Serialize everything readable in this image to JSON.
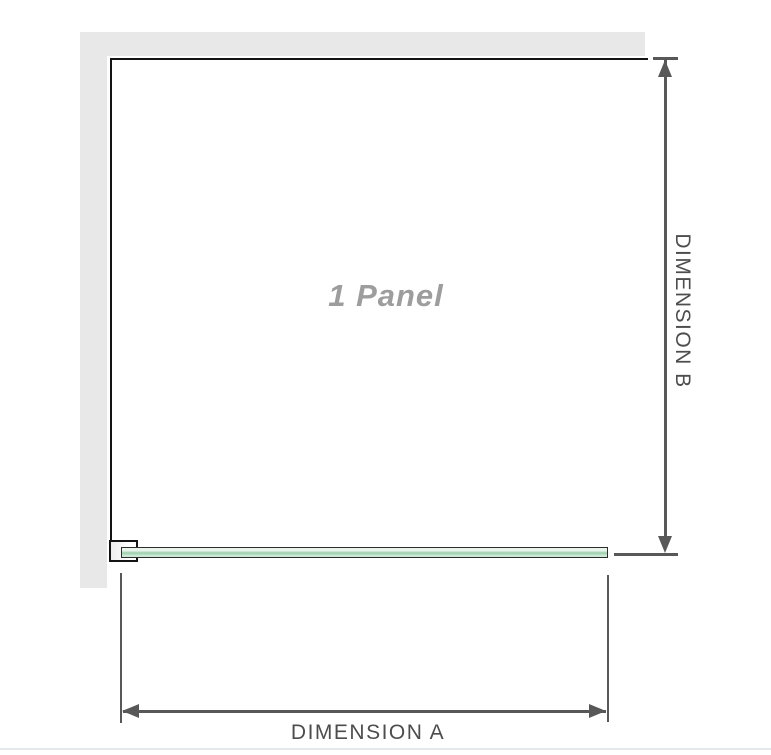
{
  "diagram": {
    "panel_label": "1 Panel",
    "dimension_a_label": "DIMENSION A",
    "dimension_b_label": "DIMENSION B",
    "colors": {
      "wall": "#e8e8e8",
      "panel_outline": "#141414",
      "dimension_line": "#585858",
      "label_text": "#4d4d4d",
      "panel_text": "#9d9d9d",
      "glass_border": "#2d2d2d",
      "glass_light": "#e9f4ec",
      "glass_mid": "#9bceac",
      "glass_lower": "#cde9d6",
      "divider": "#e4e8eb"
    }
  }
}
